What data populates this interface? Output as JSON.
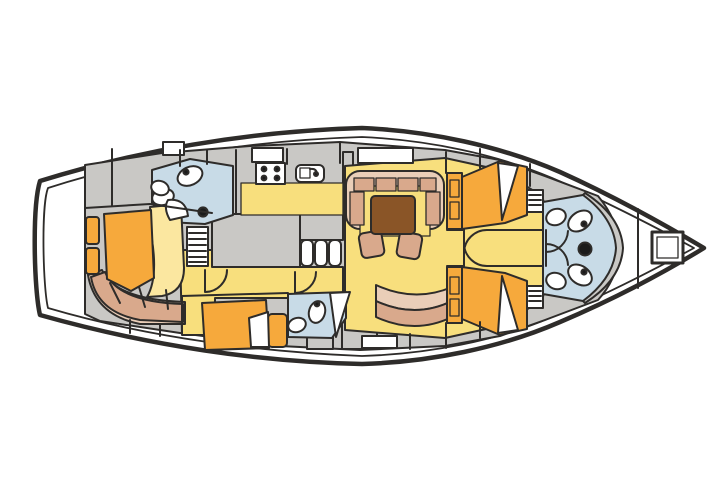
{
  "diagram": {
    "title": "Sailing yacht interior layout plan, top view",
    "type": "yacht-deck-plan",
    "orientation": {
      "bow": "right",
      "stern": "left"
    }
  },
  "colors": {
    "background": "#ffffff",
    "hull_outline": "#1d1b19",
    "wall_line": "#2e2c2a",
    "deck": "#c9c8c5",
    "floor": "#f8df7d",
    "berth": "#f6a93c",
    "bedding": "#fbe7a0",
    "settee": "#d9a98c",
    "settee_back": "#eaceb8",
    "table": "#8a5527",
    "head_floor": "#c8dbe7",
    "fixture": "#ffffff",
    "dot": "#1b1b1b"
  },
  "rooms": [
    {
      "id": "aft-owner-cabin",
      "name": "Owner cabin at stern",
      "features": [
        "angled double berth",
        "pillow",
        "curved settee",
        "two shelves"
      ]
    },
    {
      "id": "aft-head",
      "name": "Aft head",
      "features": [
        "toilet",
        "sink",
        "shower seat",
        "drain"
      ]
    },
    {
      "id": "galley",
      "name": "Galley",
      "features": [
        "four burner stove",
        "sink",
        "counters",
        "companionway ladder",
        "three steps"
      ]
    },
    {
      "id": "salon",
      "name": "Salon",
      "features": [
        "U-shaped settee",
        "dining table",
        "two chairs",
        "curved bench"
      ]
    },
    {
      "id": "mid-cabin",
      "name": "Mid cabin",
      "features": [
        "berth",
        "bedside unit"
      ]
    },
    {
      "id": "mid-head",
      "name": "Mid head",
      "features": [
        "toilet",
        "sink"
      ]
    },
    {
      "id": "fwd-cabin-starboard",
      "name": "Forward cabin starboard",
      "features": [
        "double berth",
        "shelf unit",
        "louvered locker",
        "door"
      ]
    },
    {
      "id": "fwd-cabin-port",
      "name": "Forward cabin port",
      "features": [
        "double berth",
        "shelf unit",
        "louvered locker",
        "door"
      ]
    },
    {
      "id": "bow-heads",
      "name": "Twin bow heads",
      "features": [
        "two toilets",
        "two sinks",
        "mast post",
        "two doors"
      ]
    },
    {
      "id": "forepeak",
      "name": "Forepeak",
      "features": [
        "bulkhead",
        "deck hatch"
      ]
    }
  ],
  "deck": {
    "hatch_count": 4,
    "hull_lines": 2
  }
}
